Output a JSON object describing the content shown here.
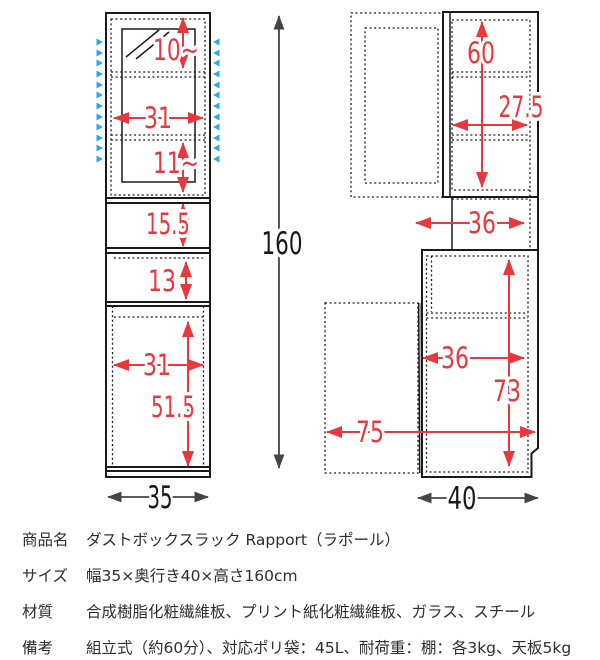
{
  "diagram": {
    "front_view": {
      "dims": {
        "glass_upper_gap": "10~",
        "glass_inner_width": "31",
        "glass_lower_gap": "11~",
        "open_shelf_height": "15.5",
        "middle_shelf_height": "13",
        "lower_inner_width": "31",
        "lower_inner_height": "51.5",
        "total_width": "35",
        "total_height": "160"
      }
    },
    "side_view": {
      "dims": {
        "upper_inner_height": "60",
        "upper_inner_depth": "27.5",
        "counter_depth": "36",
        "lower_inner_depth": "36",
        "lower_inner_height": "73",
        "door_open_depth": "75",
        "total_depth": "40"
      }
    },
    "colors": {
      "dimension_red": "#e8383d",
      "shelf_pin_blue": "#29abe2",
      "outline_black": "#1a1a1a",
      "measure_gray": "#444444"
    }
  },
  "spec_table": {
    "rows": [
      {
        "label": "商品名",
        "value": "ダストボックスラック Rapport（ラポール）"
      },
      {
        "label": "サイズ",
        "value": "幅35×奥行き40×高さ160cm"
      },
      {
        "label": "材質",
        "value": "合成樹脂化粧繊維板、プリント紙化粧繊維板、ガラス、スチール"
      },
      {
        "label": "備考",
        "value": "組立式（約60分）、対応ポリ袋：45L、耐荷重：棚：各3kg、天板5kg"
      }
    ]
  }
}
